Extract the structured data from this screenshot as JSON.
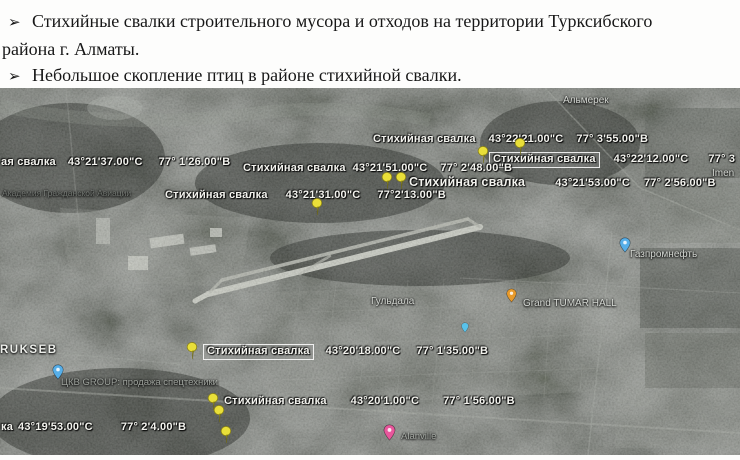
{
  "bullet_marker": "➢",
  "bullets": [
    {
      "lines": [
        "Стихийные свалки строительного мусора и отходов на территории Турксибского",
        "района г. Алматы."
      ]
    },
    {
      "lines": [
        "Небольшое скопление птиц в районе стихийной свалки."
      ]
    }
  ],
  "map": {
    "dumps": [
      {
        "label": "Стихийная свалка",
        "lat": "43°22'21.00\"С",
        "lon": "77° 3'55.00\"В"
      },
      {
        "label": "Стихийная свалка",
        "lat": "43°22'12.00\"С",
        "lon": "77° 3"
      },
      {
        "label": "Стихийная свалка",
        "lat": "43°21'51.00\"С",
        "lon": "77° 2'48.00\"В"
      },
      {
        "label": "ая свалка",
        "lat": "43°21'37.00\"С",
        "lon": "77° 1'26.00\"В"
      },
      {
        "label": "Стихийная свалка",
        "lat": "43°21'53.00\"С",
        "lon": "77° 2'56.00\"В"
      },
      {
        "label": "Стихийная свалка",
        "lat": "43°21'31.00\"С",
        "lon": "77°2'13.00\"В"
      },
      {
        "label": "Стихийная свалка",
        "lat": "43°20'18.00\"С",
        "lon": "77° 1'35.00\"В"
      },
      {
        "label": "Стихийная свалка",
        "lat": "43°20'1.00\"С",
        "lon": "77° 1'56.00\"В"
      },
      {
        "label": "ка",
        "lat": "43°19'53.00\"С",
        "lon": "77° 2'4.00\"В"
      }
    ],
    "places": [
      {
        "text": "Альмерек"
      },
      {
        "text": "Imen"
      },
      {
        "text": "Газпромнефть"
      },
      {
        "text": "Гульдала"
      },
      {
        "text": "Grand TUMAR HALL"
      },
      {
        "text": "RUKSEB"
      },
      {
        "text": "ЦКВ GROUP: продажа спецтехники"
      },
      {
        "text": "Академия Гражданской Авиации"
      },
      {
        "text": "Alanville"
      }
    ],
    "icons": {
      "yellow-pushpin-icon": "#e9df39",
      "blue-place-marker-icon": "#56aee8",
      "orange-place-marker-icon": "#e89a2b",
      "pink-place-marker-icon": "#e8579c",
      "cyan-place-marker-icon": "#59c2ea"
    },
    "label_color": "#f3f3ee"
  }
}
